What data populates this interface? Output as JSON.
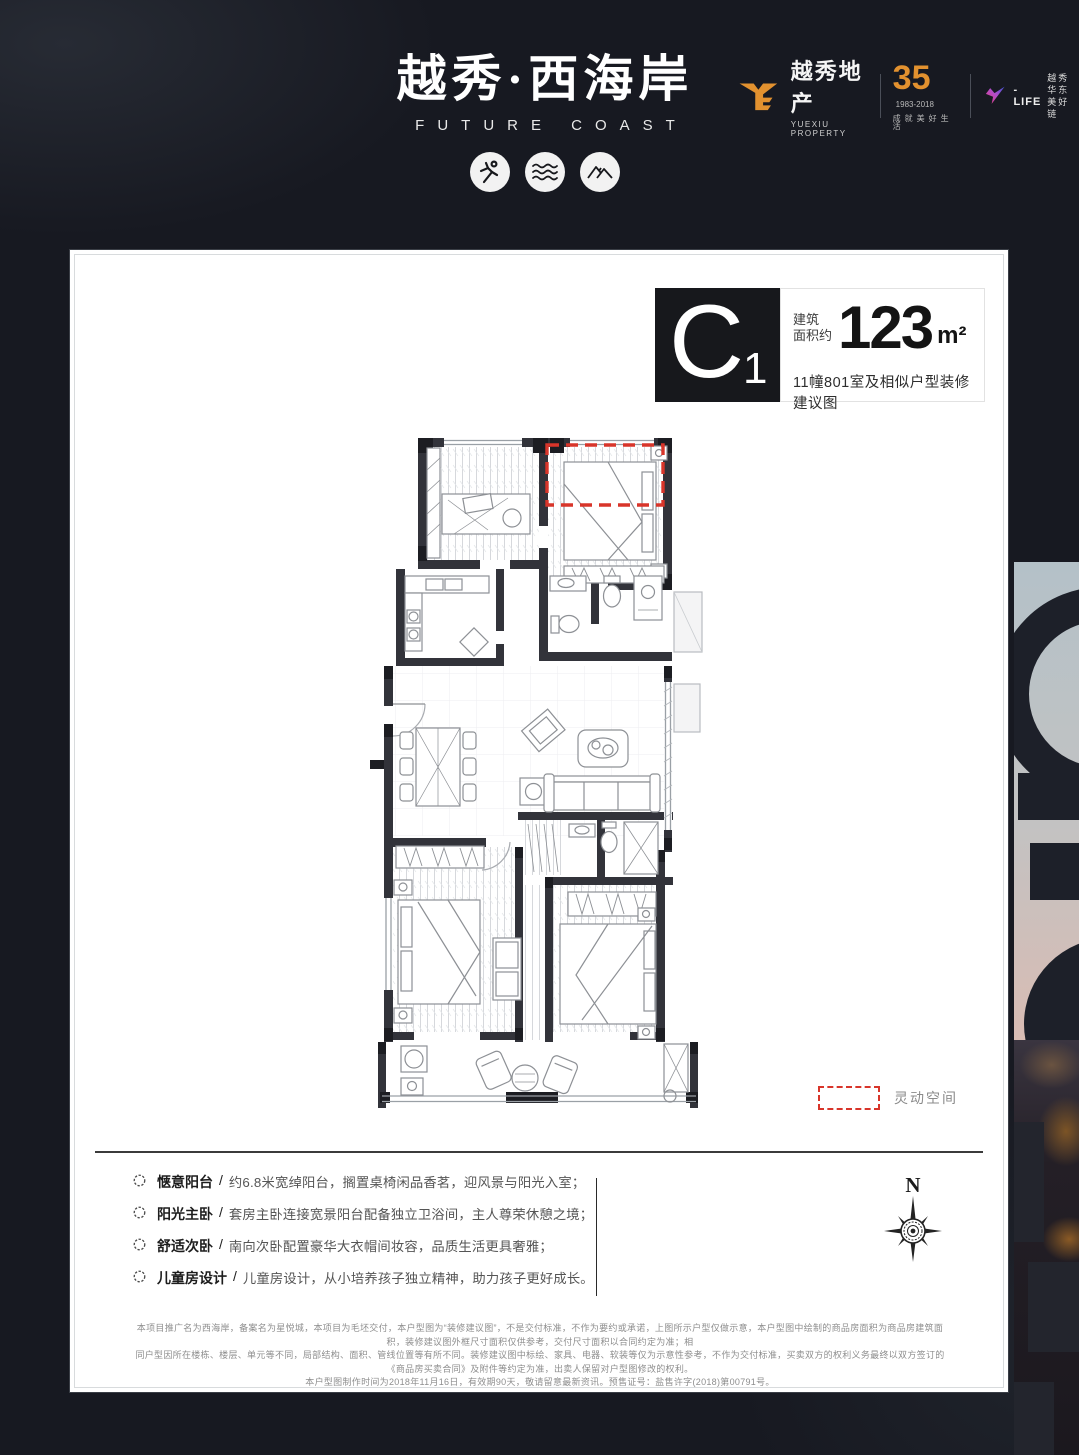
{
  "brand": {
    "logo_cn": "越秀·西海岸",
    "logo_en": "FUTURE COAST",
    "icons": [
      "runner-icon",
      "waves-icon",
      "mountains-icon"
    ],
    "corp_cn": "越秀地产",
    "corp_en": "YUEXIU PROPERTY",
    "anniversary_number": "35",
    "anniversary_years": "1983-2018",
    "anniversary_slogan": "成就美好生活",
    "partner_name": "-LIFE",
    "partner_cn_line1": "越秀华东",
    "partner_cn_line2": "美好链",
    "accent_orange": "#e2912f"
  },
  "unit": {
    "code_letter": "C",
    "code_number": "1",
    "area_label_line1": "建筑",
    "area_label_line2": "面积约",
    "area_value": "123",
    "area_unit": "m²",
    "subtitle": "11幢801室及相似户型装修建议图"
  },
  "legend": {
    "flex_space_label": "灵动空间",
    "dash_color": "#d8352a"
  },
  "compass": {
    "label": "N"
  },
  "features_sep": "/",
  "features": [
    {
      "title": "惬意阳台",
      "desc": "约6.8米宽绰阳台，搁置桌椅闲品香茗，迎风景与阳光入室；"
    },
    {
      "title": "阳光主卧",
      "desc": "套房主卧连接宽景阳台配备独立卫浴间，主人尊荣休憩之境；"
    },
    {
      "title": "舒适次卧",
      "desc": "南向次卧配置豪华大衣帽间妆容，品质生活更具奢雅；"
    },
    {
      "title": "儿童房设计",
      "desc": "儿童房设计，从小培养孩子独立精神，助力孩子更好成长。"
    }
  ],
  "disclaimer": [
    "本项目推广名为西海岸，备案名为星悦城，本项目为毛坯交付，本户型图为“装修建议图”，不是交付标准，不作为要约或承诺，上图所示户型仅做示意，本户型图中绘制的商品房面积为商品房建筑面积，装修建议图外框尺寸面积仅供参考，交付尺寸面积以合同约定为准；相",
    "同户型因所在楼栋、楼层、单元等不同，局部结构、面积、管线位置等有所不同。装修建议图中标绘、家具、电器、软装等仅为示意性参考，不作为交付标准，买卖双方的权利义务最终以双方签订的《商品房买卖合同》及附件等约定为准，出卖人保留对户型图修改的权利。",
    "本户型图制作时间为2018年11月16日，有效期90天，敬请留意最新资讯。预售证号：盐售许字(2018)第00791号。"
  ]
}
